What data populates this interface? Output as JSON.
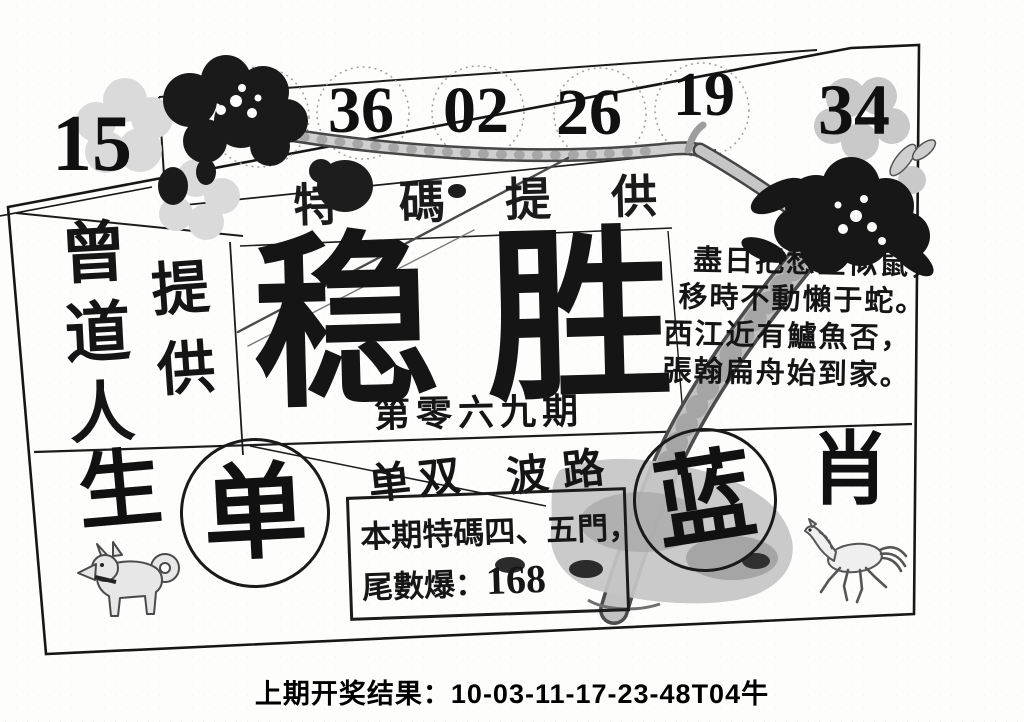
{
  "sheet": {
    "numbers": {
      "far_left": "15",
      "circled": [
        "44",
        "36",
        "02",
        "26",
        "19"
      ],
      "far_right": "34"
    },
    "band": {
      "text": "特碼提供"
    },
    "left_panel": {
      "name_column": "曾道人",
      "provide_column": "提供"
    },
    "center": {
      "headline": "稳胜",
      "issue_line": "第零六九期"
    },
    "poem": {
      "lines": [
        "盡日把愁全似鼠，",
        "移時不動懶于蛇。",
        "西江近有鱸魚否，",
        "張翰扁舟始到家。"
      ]
    },
    "bottom": {
      "left_char": "生",
      "odd_circle_char": "单",
      "odd_even_label": "单双",
      "wave_label": "波路",
      "blue_circle_char": "蓝",
      "right_char": "肖",
      "tip_box": {
        "line1": "本期特碼四、五門，",
        "line2_label": "尾數爆：",
        "line2_value": "168"
      },
      "left_animal_icon": "dog-figure",
      "right_animal_icon": "horse-figure"
    },
    "footer": {
      "label": "上期开奖结果：",
      "value": "10-03-11-17-23-48T04牛"
    },
    "colors": {
      "ink": "#141414",
      "branch_gray": "#c0c0c0",
      "trunk_gray": "#b8b8b8",
      "blossom_dark": "#1a1a1a",
      "faint_gray": "#d7d7d7"
    }
  }
}
